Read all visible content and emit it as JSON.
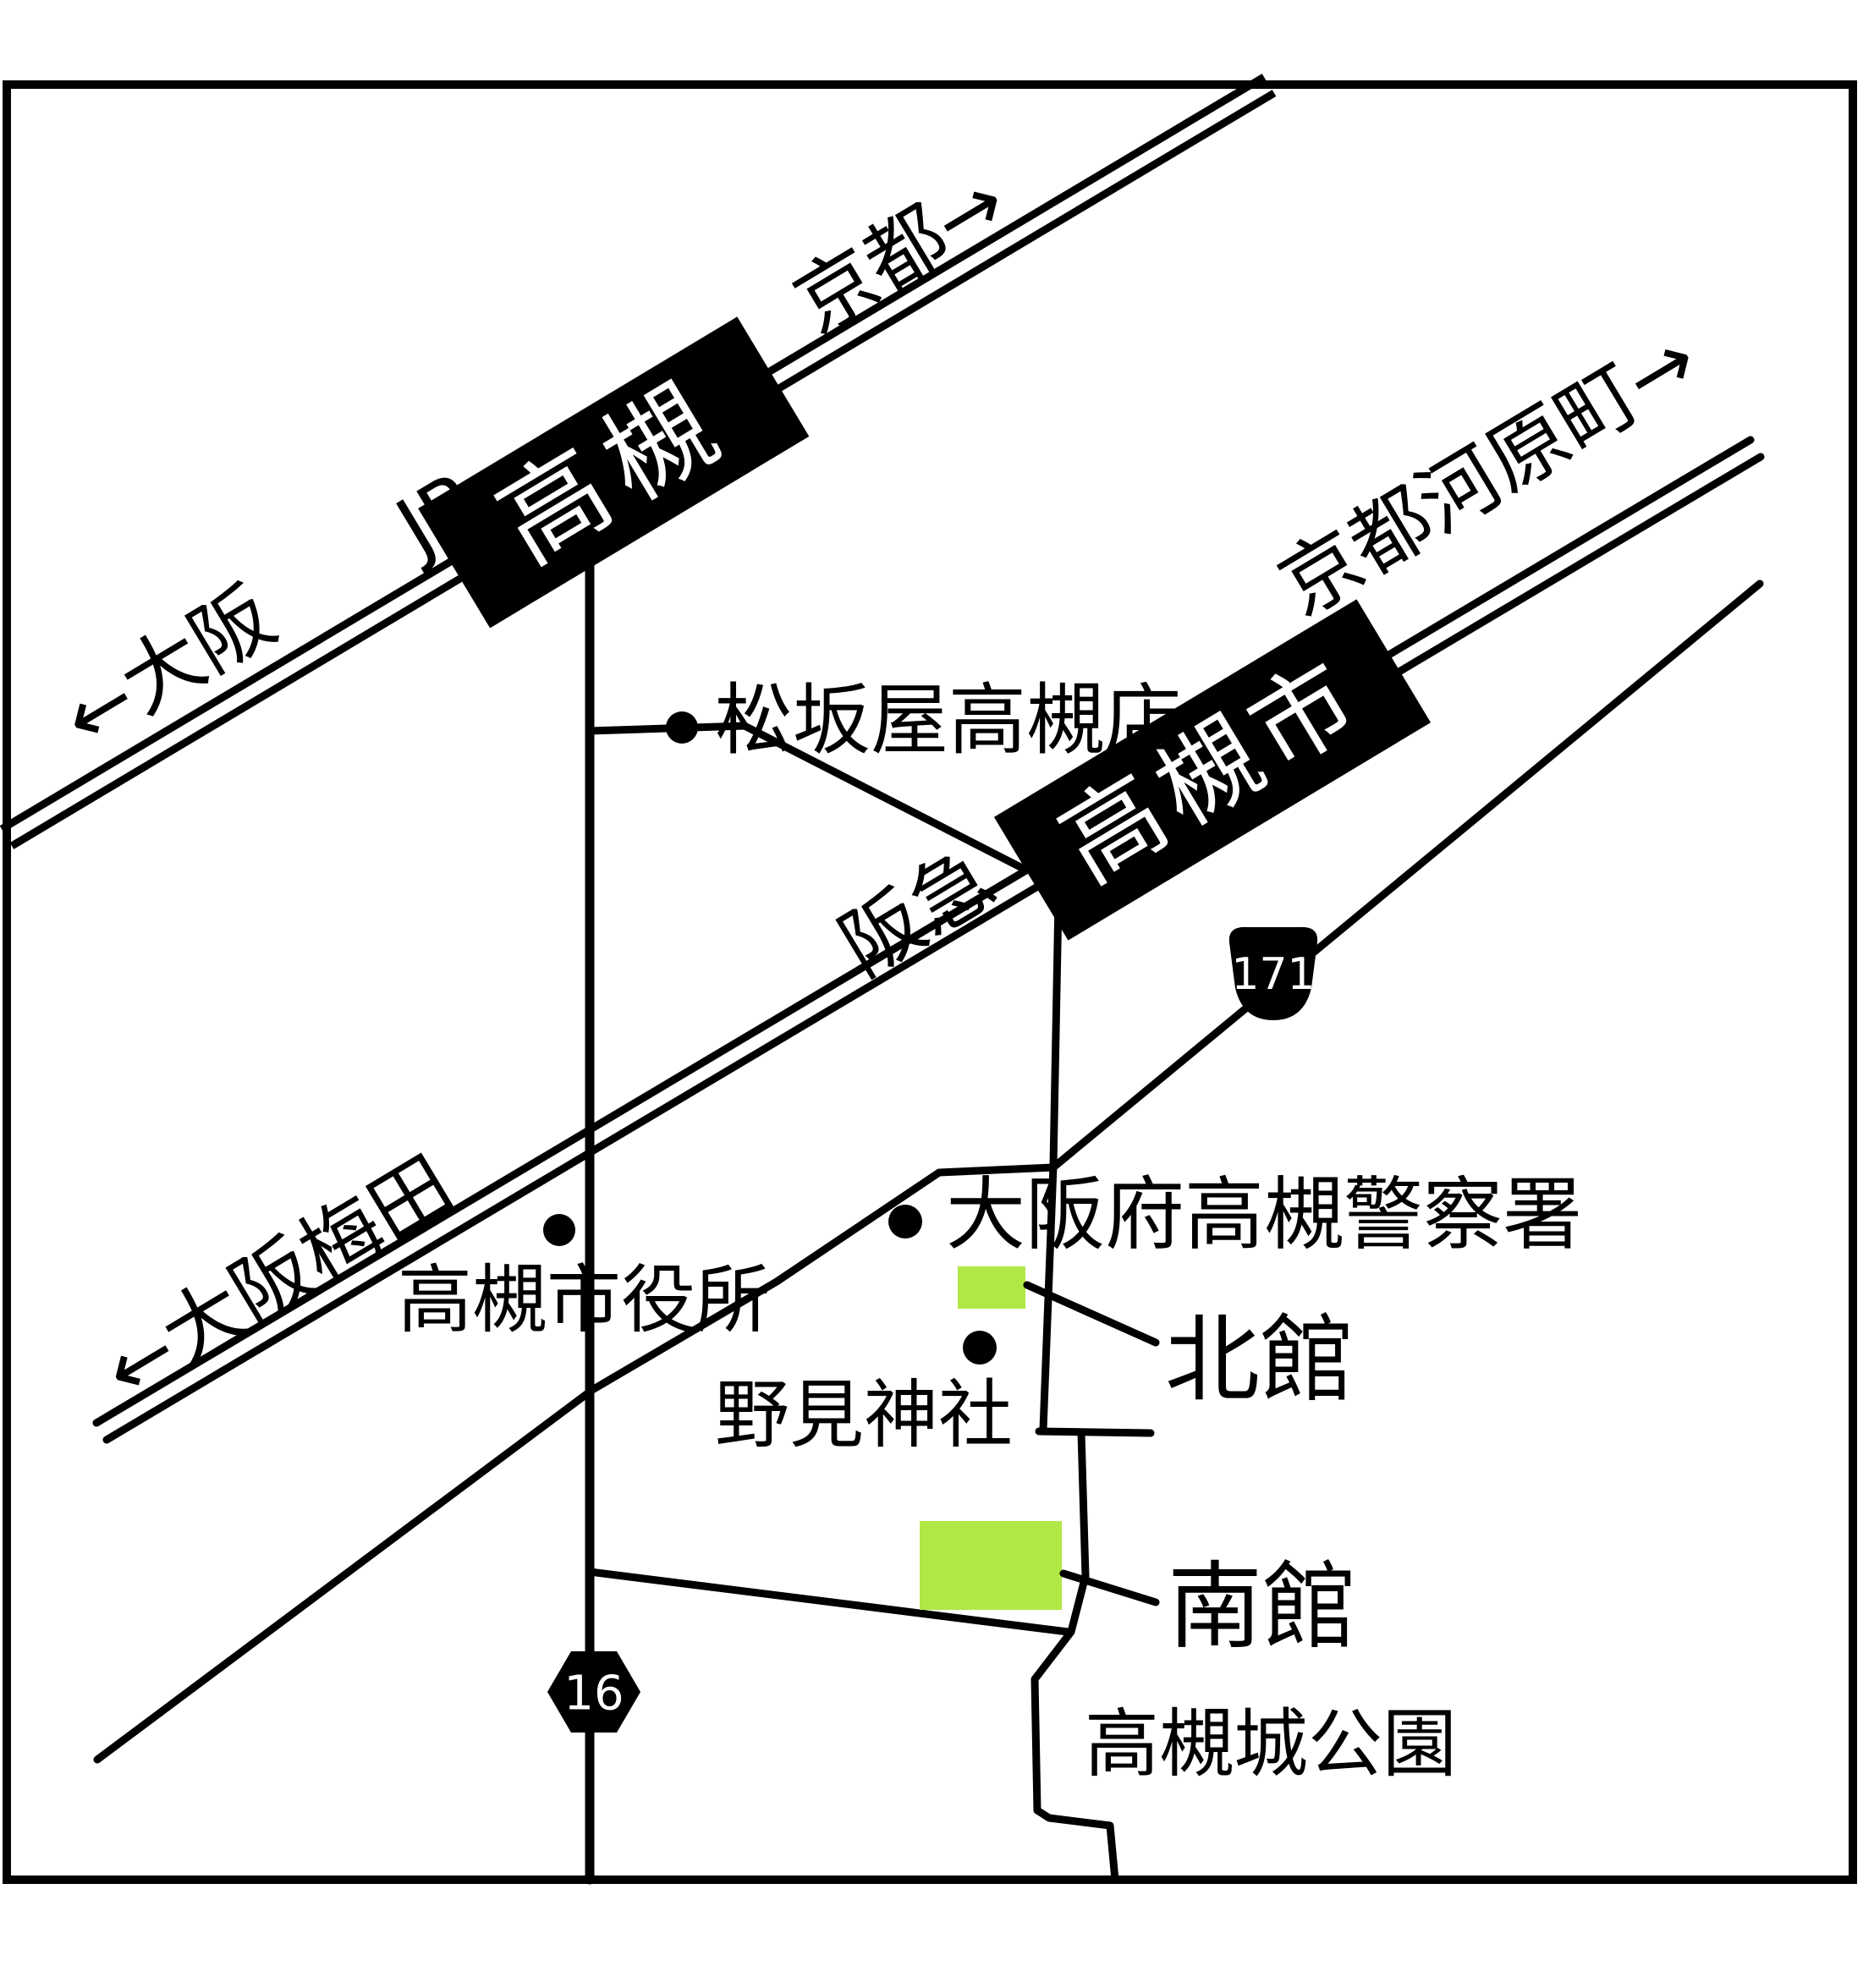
{
  "railways": {
    "jr": {
      "operator": "JR",
      "station": "高槻",
      "dir_west": "←大阪",
      "dir_east": "京都→"
    },
    "hankyu": {
      "operator": "阪急",
      "station": "高槻市",
      "dir_west": "←大阪梅田",
      "dir_east": "京都河原町→"
    }
  },
  "route_badges": {
    "national_171": "171",
    "prefectural_16": "16"
  },
  "landmarks": {
    "matsuzakaya": "松坂屋高槻店",
    "police": "大阪府高槻警察署",
    "city_hall": "高槻市役所",
    "nomi_shrine": "野見神社",
    "castle_park": "高槻城公園"
  },
  "buildings": {
    "north": "北館",
    "south": "南館"
  },
  "colors": {
    "background": "#ffffff",
    "ink": "#000000",
    "building_fill": "#b0e846",
    "station_text": "#ffffff"
  }
}
